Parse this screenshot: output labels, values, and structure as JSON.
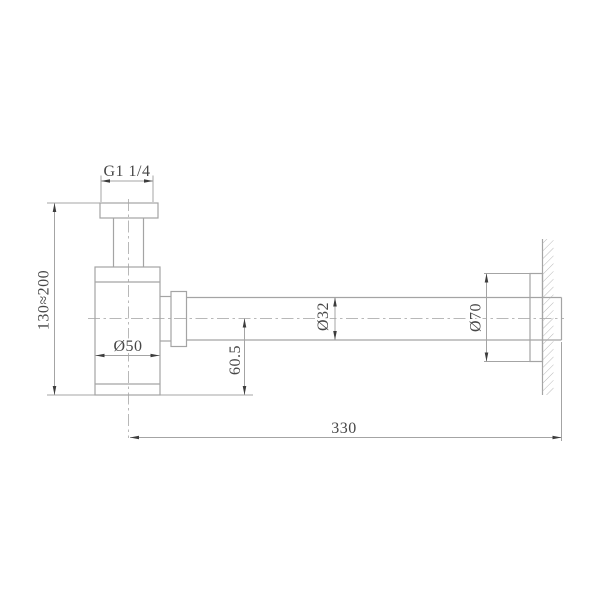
{
  "canvas": {
    "width": 600,
    "height": 600,
    "background": "#ffffff"
  },
  "drawing": {
    "kind": "technical-drawing",
    "colors": {
      "outline": "#a4a4a4",
      "centerline": "#b8b8b8",
      "dimension_line": "#a4a4a4",
      "arrow": "#3d3d3d",
      "text": "#474747",
      "hatch": "#b2b2b2"
    },
    "labels": {
      "thread_size": "G1 1/4",
      "height_range": "130≈200",
      "body_diameter": "Ø50",
      "outlet_center_height": "60.5",
      "pipe_diameter": "Ø32",
      "flange_diameter": "Ø70",
      "wall_tube_length": "330"
    }
  }
}
